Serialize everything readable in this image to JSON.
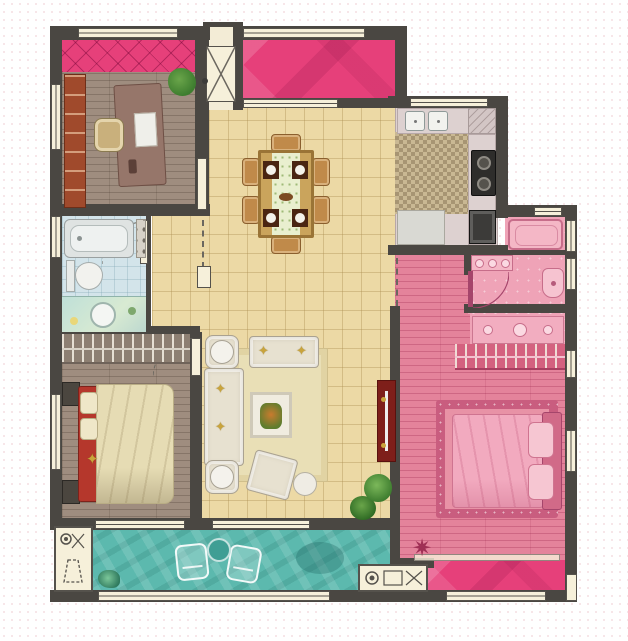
{
  "meta": {
    "type": "apartment-floor-plan",
    "canvas": {
      "width": 628,
      "height": 641
    }
  },
  "palette": {
    "wall": "#4a4742",
    "window_fill": "#f6f0da",
    "window_line": "#55524c",
    "tile_floor": "#ecd9a5",
    "entry_floor": "#f3ecd6",
    "wood_floor": "#9f8d7f",
    "balcony_pink": "#e6407a",
    "suite_pink": "#e4839b",
    "suite_bath_pink": "#efa3b7",
    "balcony_teal": "#5cb9ae",
    "bath_floor": "#d3e4ea",
    "kitchen_mosaic": "#c9b893",
    "counter": "#ddd1d0",
    "fixture_white": "#f2f2ee",
    "bed_red": "#b5372c",
    "duvet_cream": "#e6dcb4",
    "sofa_cream": "#e7e1d0",
    "rug_cream": "#e9dfb6",
    "table_wood": "#caa45c",
    "chair_tan": "#c08a4a",
    "tv_red": "#7e1f1a",
    "plant_green": "#4e8f3a",
    "shelf_red": "#a04a2c",
    "gold": "#c9a43c",
    "rug_pink_border": "#c95d7f",
    "rug_pink": "#e892a6",
    "wardrobe_gray": "#8d7f72",
    "wardrobe_pink": "#d4617f",
    "appliance_dark": "#3c3b39"
  },
  "icons": {
    "star_pillow": "✦",
    "starburst": "✷"
  },
  "rooms": [
    {
      "id": "study",
      "floor": "wood_floor",
      "highlight": "balcony_pink"
    },
    {
      "id": "entry-vestibule",
      "floor": "entry_floor"
    },
    {
      "id": "north-balcony",
      "floor": "balcony_pink"
    },
    {
      "id": "kitchen",
      "floor": "kitchen_mosaic"
    },
    {
      "id": "dining-living-room",
      "floor": "tile_floor"
    },
    {
      "id": "bathroom",
      "floor": "bath_floor"
    },
    {
      "id": "bedroom-2",
      "floor": "wood_floor"
    },
    {
      "id": "master-suite",
      "floor": "suite_pink"
    },
    {
      "id": "master-bathroom",
      "floor": "suite_bath_pink"
    },
    {
      "id": "south-balcony",
      "floor": "balcony_teal"
    },
    {
      "id": "master-balcony",
      "floor": "balcony_pink"
    },
    {
      "id": "utility-closet",
      "floor": "window_fill"
    },
    {
      "id": "equipment-bay",
      "floor": "window_fill"
    }
  ]
}
